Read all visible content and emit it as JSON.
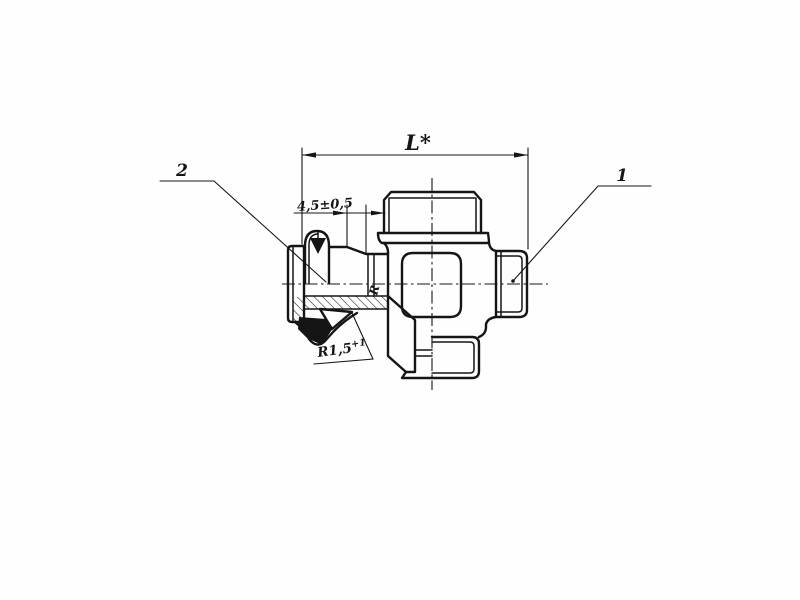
{
  "drawing": {
    "type": "sectioned technical drawing of cross-shaped valve fitting with grease nipple",
    "colors": {
      "line": "#151515",
      "background": "#fefefe"
    },
    "labels": {
      "length_dimension": "L*",
      "offset_dimension": "4,5±0,5",
      "radius_value": "R1,5",
      "radius_tolerance": "+1",
      "part_ref_right": "1",
      "part_ref_left": "2",
      "section_mark": "R"
    }
  }
}
